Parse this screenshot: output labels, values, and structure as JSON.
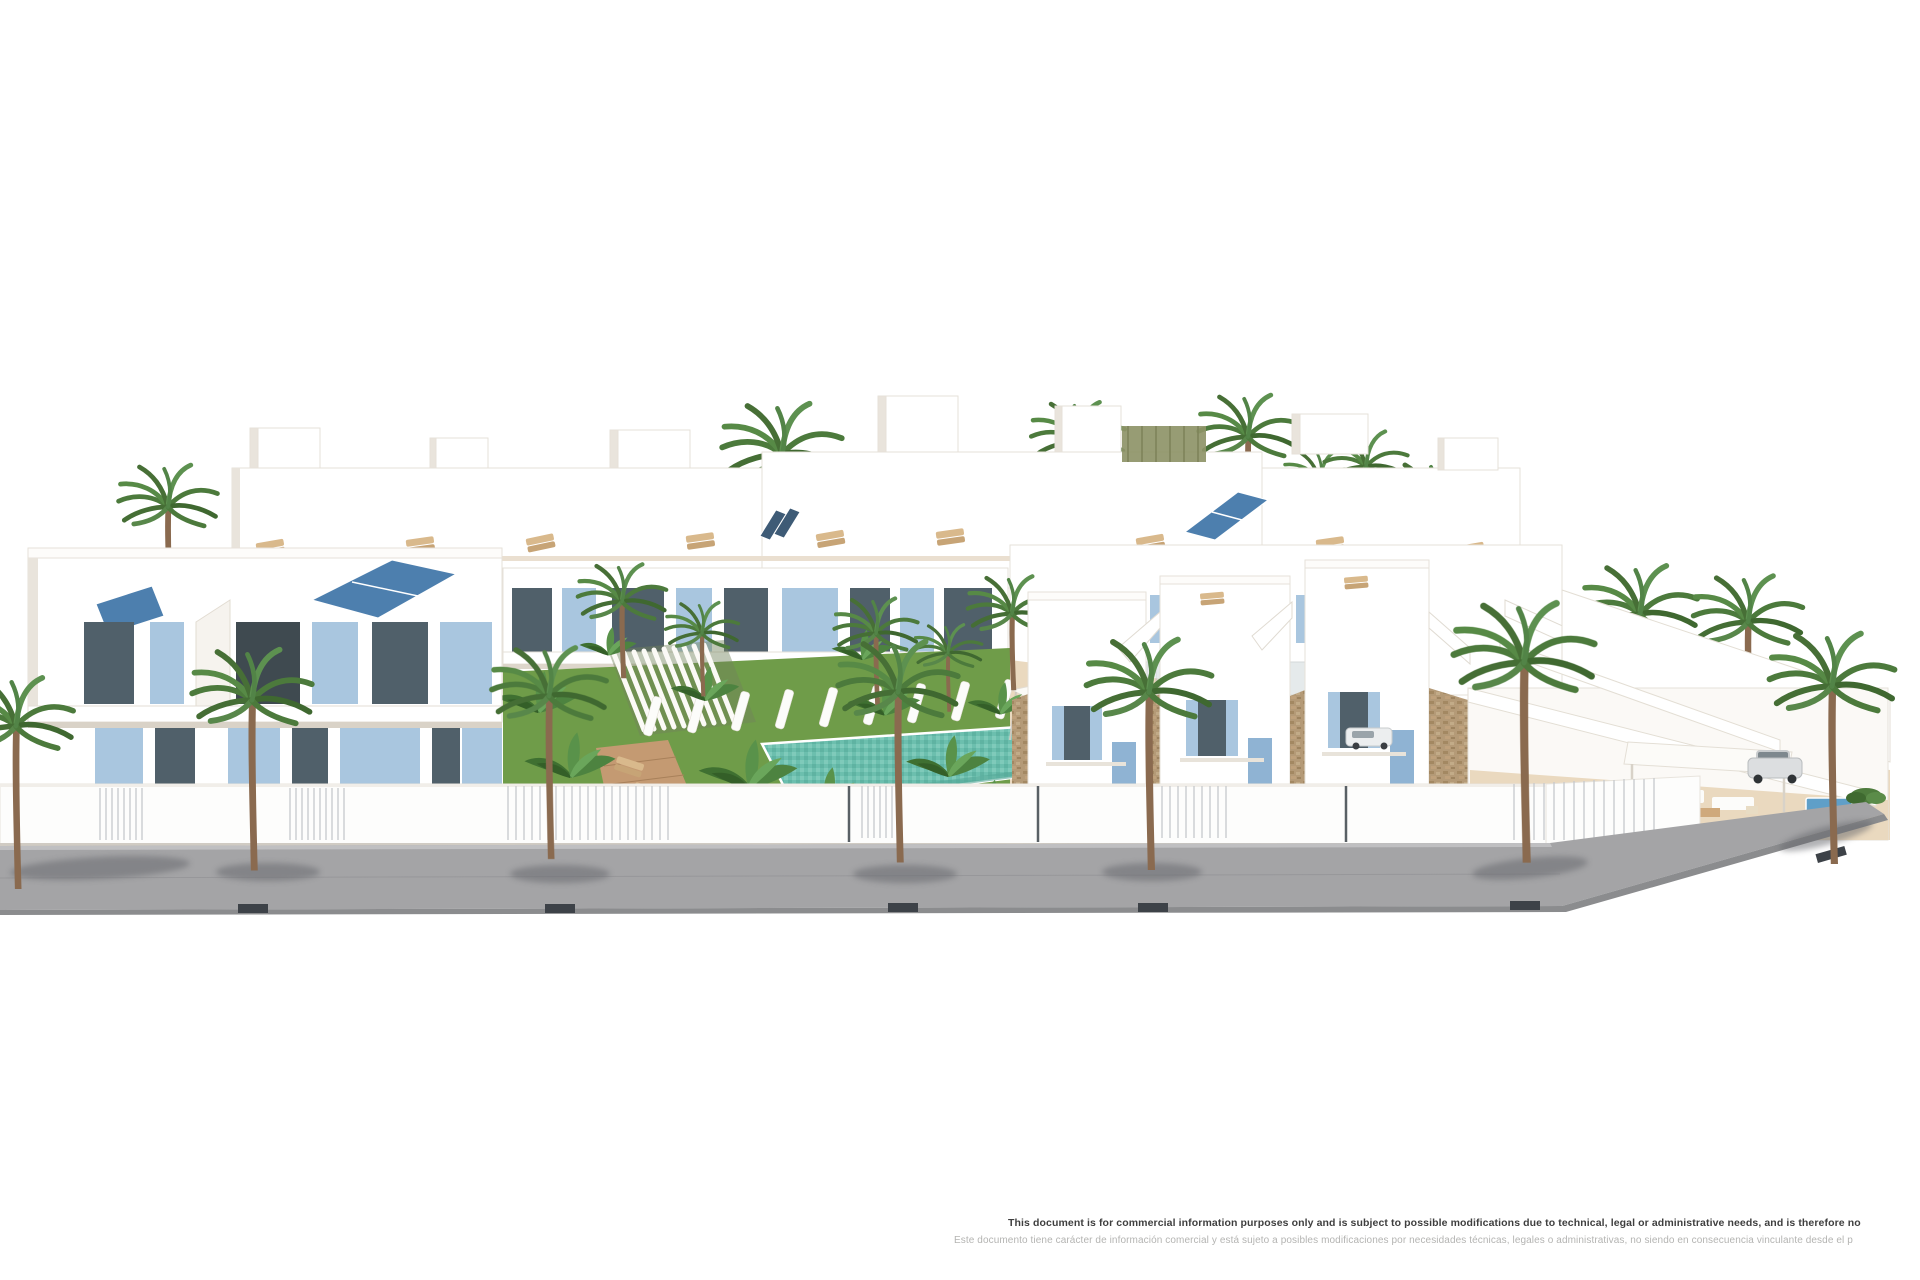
{
  "disclaimer": {
    "en": "This document is for commercial information purposes only and is subject to possible modifications due to technical, legal or administrative needs, and is therefore no",
    "es": "Este documento tiene carácter de información comercial y está sujeto a posibles modificaciones por necesidades técnicas, legales o administrativas, no siendo en consecuencia vinculante desde el p"
  },
  "scene_labels": {
    "render": "residential-development-render",
    "pool": "communal-swimming-pool",
    "lawn": "communal-lawn",
    "road": "sidewalk-pavement"
  },
  "colors": {
    "solar_panel_blue": "#4d7fae",
    "shutter_blue": "#a9c6df",
    "glass_dark": "#50606a",
    "lawn_green": "#6f9c49",
    "lawn_green_dark": "#57833a",
    "pool_teal": "#6cbfae",
    "pool_teal_light": "#8fd0c0",
    "pavement_gray": "#a4a4a6",
    "curb_gray": "#8b8c8e",
    "tree_pit_dark": "#3d4248",
    "stone_tan": "#b49a77",
    "wood_deck": "#c49a72",
    "terrace_beige": "#ead9bf",
    "palm_green": "#4c7a3c",
    "trunk_brown": "#8a6a4f",
    "building_white": "#ffffff",
    "building_shade": "#e9e4dc",
    "text_dark": "#3f3f3f",
    "text_light": "#b4b4b2"
  }
}
